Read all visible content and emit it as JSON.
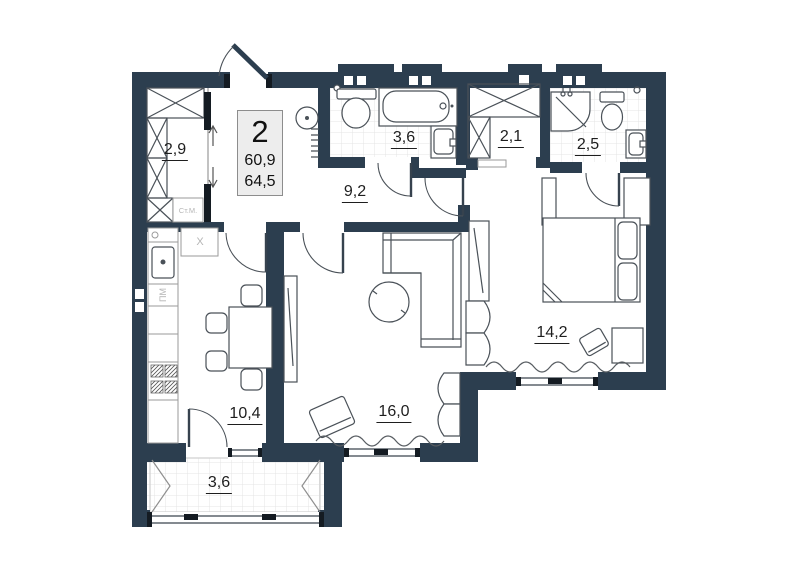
{
  "floor_plan": {
    "colors": {
      "wall": "#2c3e4f",
      "line": "#4a5158",
      "text": "#1e1e1e",
      "muted": "#b5b5b5",
      "box_bg": "#ededed",
      "box_border": "#8d8d8d"
    },
    "info_box": {
      "room_count": "2",
      "living_area": "60,9",
      "total_area": "64,5"
    },
    "labels": {
      "wardrobe": "2,9",
      "bathroom": "3,6",
      "closet": "2,1",
      "shower": "2,5",
      "hallway": "9,2",
      "bedroom": "14,2",
      "kitchen": "10,4",
      "living_room": "16,0",
      "balcony": "3,6"
    },
    "appliances": {
      "washing_machine": "Ст.М.",
      "dishwasher": "ПМ",
      "fridge": "X"
    }
  }
}
